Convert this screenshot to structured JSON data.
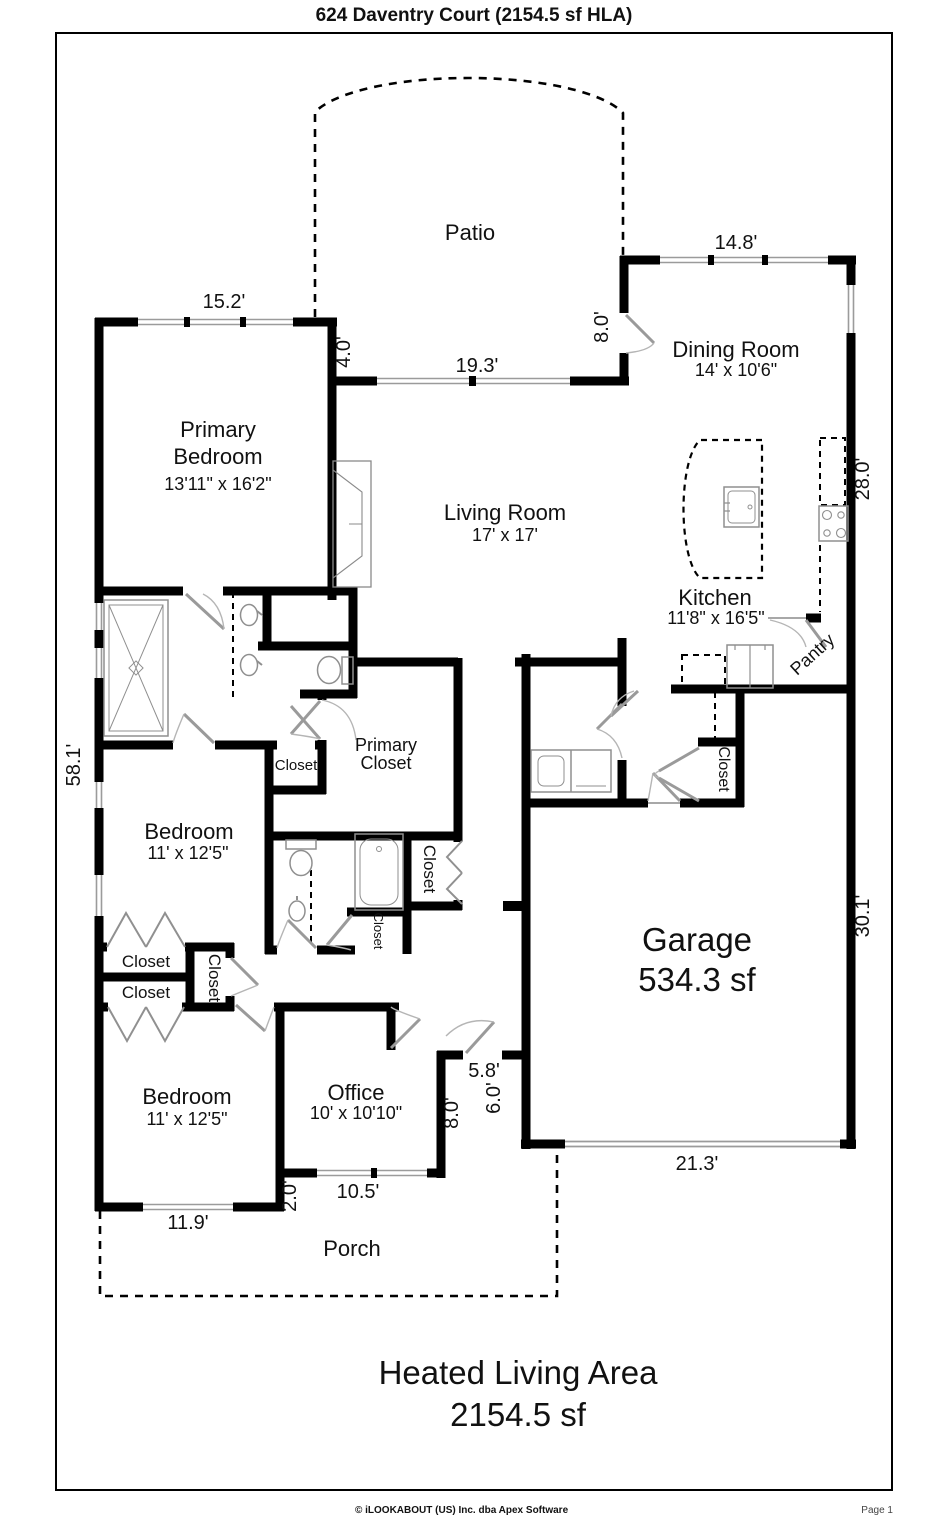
{
  "title": "624 Daventry Court (2154.5 sf HLA)",
  "colors": {
    "wall": "#000000",
    "window": "#9b9b9b",
    "fixture": "#8f8f8f",
    "text": "#111111"
  },
  "rooms": {
    "patio": {
      "name": "Patio"
    },
    "primary_bedroom": {
      "name_line1": "Primary",
      "name_line2": "Bedroom",
      "size": "13'11\" x 16'2\""
    },
    "living_room": {
      "name": "Living Room",
      "size": "17' x 17'"
    },
    "dining_room": {
      "name": "Dining Room",
      "size": "14' x 10'6\""
    },
    "kitchen": {
      "name": "Kitchen",
      "size": "11'8\" x 16'5\""
    },
    "pantry": {
      "name": "Pantry"
    },
    "primary_closet": {
      "name_line1": "Primary",
      "name_line2": "Closet"
    },
    "bedroom_mid": {
      "name": "Bedroom",
      "size": "11' x 12'5\""
    },
    "bedroom_front": {
      "name": "Bedroom",
      "size": "11' x 12'5\""
    },
    "office": {
      "name": "Office",
      "size": "10' x 10'10\""
    },
    "garage": {
      "name": "Garage",
      "area": "534.3 sf"
    },
    "porch": {
      "name": "Porch"
    },
    "closet_linen": {
      "name": "Closet"
    },
    "closet_garage": {
      "name": "Closet"
    },
    "closet_bath": {
      "name": "Closet"
    },
    "closet_tub": {
      "name": "Closet"
    },
    "closet_hall_upper": {
      "name": "Closet"
    },
    "closet_hall_lower": {
      "name": "Closet"
    },
    "closet_hall_vertical": {
      "name": "Closet"
    }
  },
  "dimensions": {
    "primary_top": "15.2'",
    "primary_east": "4.0'",
    "patio_wall": "19.3'",
    "patio_east": "8.0'",
    "dining_top": "14.8'",
    "east_upper": "28.0'",
    "west_side": "58.1'",
    "garage_east": "30.1'",
    "garage_bottom": "21.3'",
    "entry_width": "5.8'",
    "entry_depth": "6.0'",
    "entry_side": "8.0'",
    "office_bottom": "10.5'",
    "office_jog": "2.0'",
    "bedroom_bottom": "11.9'"
  },
  "summary": {
    "line1": "Heated Living Area",
    "line2": "2154.5 sf"
  },
  "footer": {
    "copyright": "© iLOOKABOUT (US) Inc. dba Apex Software",
    "page": "Page 1"
  }
}
